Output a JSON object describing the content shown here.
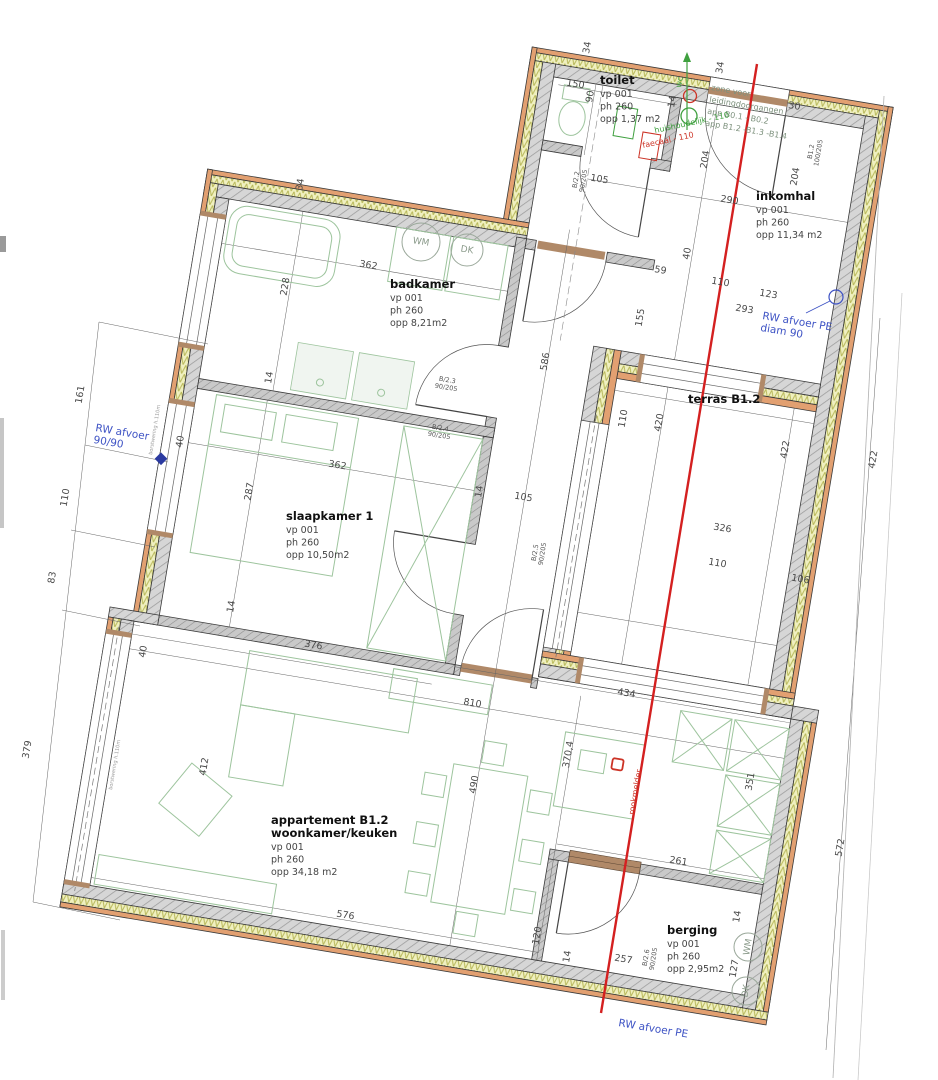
{
  "colors": {
    "wall_gray": "#d6d6d6",
    "insulation_yellow": "#f0f0c0",
    "cladding_orange": "#e2a071",
    "furniture_green": "#9dc49d",
    "annotation_blue": "#3d52c4",
    "annotation_green": "#3fa03f",
    "annotation_red": "#cc3326",
    "reference_line_red": "#d42020"
  },
  "rooms": [
    {
      "name": "toilet",
      "sub": [
        "vp 001",
        "ph 260",
        "opp 1,37 m2"
      ],
      "x": 600,
      "y": 84
    },
    {
      "name": "badkamer",
      "sub": [
        "vp 001",
        "ph 260",
        "opp 8,21m2"
      ],
      "x": 390,
      "y": 288
    },
    {
      "name": "slaapkamer 1",
      "sub": [
        "vp 001",
        "ph 260",
        "opp 10,50m2"
      ],
      "x": 286,
      "y": 520
    },
    {
      "name": "inkomhal",
      "sub": [
        "vp 001",
        "ph 260",
        "opp 11,34 m2"
      ],
      "x": 756,
      "y": 200
    },
    {
      "name": "terras  B1.2",
      "sub": [],
      "x": 688,
      "y": 403
    },
    {
      "name": "appartement B1.2",
      "name2": "woonkamer/keuken",
      "sub": [
        "vp 001",
        "ph 260",
        "opp 34,18 m2"
      ],
      "x": 271,
      "y": 824
    },
    {
      "name": "berging",
      "sub": [
        "vp 001",
        "ph 260",
        "opp 2,95m2"
      ],
      "x": 667,
      "y": 934
    }
  ],
  "dims": [
    {
      "t": "362",
      "x": 368,
      "y": 268,
      "r": 9.5
    },
    {
      "t": "228",
      "x": 288,
      "y": 287,
      "r": -80.5
    },
    {
      "t": "34",
      "x": 303,
      "y": 185,
      "r": -80.5
    },
    {
      "t": "14",
      "x": 272,
      "y": 378,
      "r": -80.5
    },
    {
      "t": "362",
      "x": 337,
      "y": 468,
      "r": 9.5
    },
    {
      "t": "287",
      "x": 252,
      "y": 492,
      "r": -80.5
    },
    {
      "t": "14",
      "x": 234,
      "y": 607,
      "r": -80.5
    },
    {
      "t": "376",
      "x": 313,
      "y": 648,
      "r": 9.5
    },
    {
      "t": "40",
      "x": 146,
      "y": 652,
      "r": -80.5
    },
    {
      "t": "412",
      "x": 207,
      "y": 767,
      "r": -80.5
    },
    {
      "t": "810",
      "x": 472,
      "y": 706,
      "r": 9.5
    },
    {
      "t": "370,4",
      "x": 571,
      "y": 755,
      "r": -80.5
    },
    {
      "t": "490",
      "x": 477,
      "y": 785,
      "r": -80.5
    },
    {
      "t": "576",
      "x": 345,
      "y": 918,
      "r": 9.5
    },
    {
      "t": "120",
      "x": 540,
      "y": 936,
      "r": -80.5
    },
    {
      "t": "14",
      "x": 570,
      "y": 957,
      "r": -80.5
    },
    {
      "t": "257",
      "x": 623,
      "y": 962,
      "r": 9.5
    },
    {
      "t": "127",
      "x": 737,
      "y": 969,
      "r": -80.5
    },
    {
      "t": "14",
      "x": 740,
      "y": 917,
      "r": -80.5
    },
    {
      "t": "261",
      "x": 678,
      "y": 864,
      "r": 9.5
    },
    {
      "t": "351",
      "x": 753,
      "y": 782,
      "r": -80.5
    },
    {
      "t": "434",
      "x": 626,
      "y": 696,
      "r": 9.5
    },
    {
      "t": "105",
      "x": 523,
      "y": 500,
      "r": 9.5
    },
    {
      "t": "14",
      "x": 482,
      "y": 492,
      "r": -80.5
    },
    {
      "t": "586",
      "x": 548,
      "y": 362,
      "r": -80.5
    },
    {
      "t": "105",
      "x": 599,
      "y": 182,
      "r": 9.5
    },
    {
      "t": "150",
      "x": 575,
      "y": 87,
      "r": 9.5
    },
    {
      "t": "90",
      "x": 593,
      "y": 97,
      "r": -80.5
    },
    {
      "t": "34",
      "x": 590,
      "y": 48,
      "r": -80.5
    },
    {
      "t": "14",
      "x": 675,
      "y": 102,
      "r": -80.5
    },
    {
      "t": "34",
      "x": 723,
      "y": 68,
      "r": -80.5
    },
    {
      "t": "30",
      "x": 794,
      "y": 109,
      "r": 9.5
    },
    {
      "t": "290",
      "x": 729,
      "y": 203,
      "r": 9.5
    },
    {
      "t": "204",
      "x": 708,
      "y": 160,
      "r": -80.5
    },
    {
      "t": "204",
      "x": 798,
      "y": 177,
      "r": -80.5
    },
    {
      "t": "110",
      "x": 720,
      "y": 285,
      "r": 9.5
    },
    {
      "t": "59",
      "x": 660,
      "y": 273,
      "r": 9.5
    },
    {
      "t": "40",
      "x": 690,
      "y": 254,
      "r": -80.5
    },
    {
      "t": "293",
      "x": 744,
      "y": 312,
      "r": 9.5
    },
    {
      "t": "123",
      "x": 768,
      "y": 297,
      "r": 9.5
    },
    {
      "t": "155",
      "x": 643,
      "y": 318,
      "r": -80.5
    },
    {
      "t": "110",
      "x": 626,
      "y": 419,
      "r": -80.5
    },
    {
      "t": "420",
      "x": 662,
      "y": 423,
      "r": -80.5
    },
    {
      "t": "422",
      "x": 788,
      "y": 450,
      "r": -80.5
    },
    {
      "t": "326",
      "x": 722,
      "y": 531,
      "r": 9.5
    },
    {
      "t": "110",
      "x": 717,
      "y": 566,
      "r": 9.5
    },
    {
      "t": "106",
      "x": 800,
      "y": 582,
      "r": 9.5
    },
    {
      "t": "422",
      "x": 876,
      "y": 460,
      "r": -80.5
    },
    {
      "t": "572",
      "x": 843,
      "y": 848,
      "r": -80.5
    },
    {
      "t": "161",
      "x": 83,
      "y": 395,
      "r": -80.5
    },
    {
      "t": "110",
      "x": 68,
      "y": 498,
      "r": -80.5
    },
    {
      "t": "83",
      "x": 55,
      "y": 578,
      "r": -80.5
    },
    {
      "t": "379",
      "x": 30,
      "y": 750,
      "r": -80.5
    },
    {
      "t": "40",
      "x": 183,
      "y": 442,
      "r": -80.5
    }
  ],
  "door_labels": [
    {
      "l1": "B/2.2",
      "l2": "90/205",
      "x": 578,
      "y": 180,
      "r": -80.5
    },
    {
      "l1": "B/2.3",
      "l2": "90/205",
      "x": 447,
      "y": 382,
      "r": 9.5
    },
    {
      "l1": "B/2.4",
      "l2": "90/205",
      "x": 440,
      "y": 430,
      "r": 9.5
    },
    {
      "l1": "B/2.5",
      "l2": "90/205",
      "x": 537,
      "y": 553,
      "r": -80.5
    },
    {
      "l1": "B/2.6",
      "l2": "90/205",
      "x": 648,
      "y": 958,
      "r": -80.5
    },
    {
      "l1": "B1.2",
      "l2": "100/205",
      "x": 813,
      "y": 152,
      "r": -80.5
    }
  ],
  "notes": {
    "rw_left": {
      "lines": [
        "RW afvoer",
        "90/90"
      ],
      "x": 95,
      "y": 431,
      "r": 9.5,
      "cls": "blue-t"
    },
    "rw_right": {
      "lines": [
        "RW afvoer PE",
        "diam 90"
      ],
      "x": 762,
      "y": 319,
      "r": 9.5,
      "cls": "blue-t"
    },
    "rw_bottom": {
      "lines": [
        "RW afvoer PE"
      ],
      "x": 618,
      "y": 1026,
      "r": 9.5,
      "cls": "blue-t"
    },
    "zone": {
      "lines": [
        "zone voor",
        "leidingdoorgangen",
        "app B0.1 - B0.2",
        "app B1.2 -B1.3 -B1.4"
      ],
      "x": 711,
      "y": 90,
      "r": 9.5,
      "cls": "zone-t"
    },
    "huishoudelijk": {
      "lines": [
        "huishoudelijk - 110"
      ],
      "x": 655,
      "y": 133,
      "r": -12,
      "cls": "green-t"
    },
    "faecaal": {
      "lines": [
        "faecaal - 110"
      ],
      "x": 643,
      "y": 148,
      "r": -12,
      "cls": "red-t"
    },
    "rookmelder": {
      "lines": [
        "rookmelder"
      ],
      "x": 634,
      "y": 815,
      "r": -80.5,
      "cls": "red-t"
    },
    "wc": {
      "lines": [
        "wc"
      ],
      "x": 681,
      "y": 88,
      "r": -80.5,
      "cls": "green-t"
    },
    "borstwering1": {
      "lines": [
        "borstwering h.110m"
      ],
      "x": 152,
      "y": 455,
      "r": -80.5,
      "cls": "tiny-t"
    },
    "borstwering2": {
      "lines": [
        "borstwering h.110m"
      ],
      "x": 112,
      "y": 790,
      "r": -80.5,
      "cls": "tiny-t"
    }
  },
  "appliances": [
    {
      "t": "WM",
      "x": 421,
      "y": 242,
      "rad": 19,
      "r": 9.5
    },
    {
      "t": "DK",
      "x": 467,
      "y": 250,
      "rad": 16,
      "r": 9.5
    },
    {
      "t": "WM",
      "x": 748,
      "y": 947,
      "rad": 14,
      "r": -80.5
    },
    {
      "t": "DK",
      "x": 746,
      "y": 991,
      "rad": 14,
      "r": -80.5
    }
  ]
}
